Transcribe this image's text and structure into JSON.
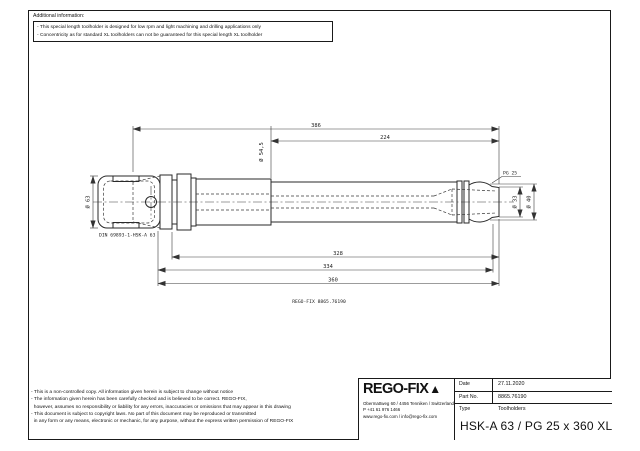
{
  "additional_info": {
    "label": "Additional information:",
    "lines": [
      "- This special length toolholder is designed for low rpm and light machining and drilling applications only",
      "- Concentricity as for standard XL toolholders can not be guaranteed for this special length XL toolholder"
    ]
  },
  "drawing": {
    "dim_overall_length": "386",
    "dim_neck_length": "224",
    "dim_body_diameter": "Ø 54,5",
    "dim_flange_diameter": "Ø 63",
    "shank_standard_label": "DIN 69893-1-HSK-A 63",
    "collet_system_label": "PG 25",
    "dim_tip_diameter": "Ø 33",
    "dim_nose_diameter": "Ø 40",
    "dim_length_1": "328",
    "dim_length_2": "334",
    "dim_length_3": "360",
    "part_caption": "REGO-FIX 8865.76190"
  },
  "legal": {
    "lines": [
      "- This is a non-controlled copy. All information given herein is subject to change without notice",
      "- The information given herein has been carefully checked and is believed to be correct. REGO-FIX,",
      "  however, assumes no responsibility or liability for any errors, inaccuracies or omissions that may appear in this drawing",
      "- This document is subject to copyright laws. No part of this document may be reproduced or transmitted",
      "  in any form or any means, electronic or mechanic, for any purpose, without the express written permission of REGO-FIX"
    ]
  },
  "title_block": {
    "logo_text": "REGO-FIX",
    "logo_mark": "▲",
    "address_lines": [
      "Obermattweg 60 / 4456 Tenniken / Switzerland",
      "P +41 61 976 1466",
      "www.rego-fix.com / info@rego-fix.com"
    ],
    "fields": [
      {
        "label": "Date",
        "value": "27.11.2020"
      },
      {
        "label": "Part No.",
        "value": "8865.76190"
      },
      {
        "label": "Type",
        "value": "Toolholders"
      }
    ],
    "title": "HSK-A 63 / PG 25 x 360 XL"
  }
}
